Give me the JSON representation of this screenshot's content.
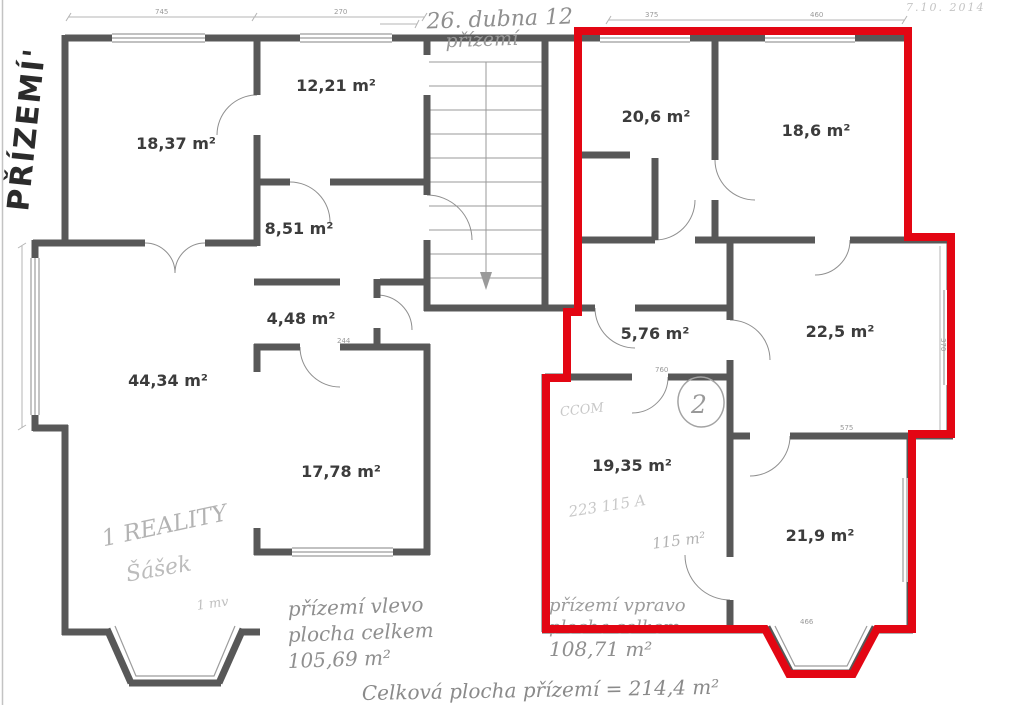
{
  "document": {
    "floor_label_vertical": "PŘÍZEMÍ'",
    "top_note_line1": "26. dubna 12",
    "top_note_line2": "přízemí",
    "scan_date": "7.10. 2014"
  },
  "rooms": [
    {
      "id": "room-18-37",
      "area": "18,37 m²"
    },
    {
      "id": "room-12-21",
      "area": "12,21 m²"
    },
    {
      "id": "room-8-51",
      "area": "8,51 m²"
    },
    {
      "id": "room-4-48",
      "area": "4,48 m²"
    },
    {
      "id": "room-44-34",
      "area": "44,34 m²"
    },
    {
      "id": "room-17-78",
      "area": "17,78 m²"
    },
    {
      "id": "room-20-6",
      "area": "20,6 m²"
    },
    {
      "id": "room-18-6",
      "area": "18,6 m²"
    },
    {
      "id": "room-5-76",
      "area": "5,76 m²"
    },
    {
      "id": "room-22-5",
      "area": "22,5 m²"
    },
    {
      "id": "room-19-35",
      "area": "19,35 m²"
    },
    {
      "id": "room-21-9",
      "area": "21,9 m²"
    }
  ],
  "handwritten": {
    "realty_line1": "1 REALITY",
    "realty_line2": "Šášek",
    "mv_note": "1 mv",
    "ccom_note": "CCOM",
    "code_note": "223 115 A",
    "area_note": "115 m²",
    "circle_number": "2",
    "left_summary": {
      "l1": "přízemí vlevo",
      "l2": "plocha celkem",
      "l3": "105,69 m²"
    },
    "right_summary": {
      "l1": "přízemí vpravo",
      "l2": "plocha celkem",
      "l3": "108,71 m²"
    },
    "total_note": "Celková plocha přízemí = 214,4 m²"
  },
  "dimensions": {
    "top1": "745",
    "top2": "270",
    "top3": "375",
    "top4": "460",
    "d244": "244",
    "d760": "760",
    "d370": "370",
    "d575": "575",
    "d466": "466"
  },
  "colors": {
    "red_outline": "#e30613",
    "wall": "#585858",
    "pencil": "#9a9a9a"
  }
}
